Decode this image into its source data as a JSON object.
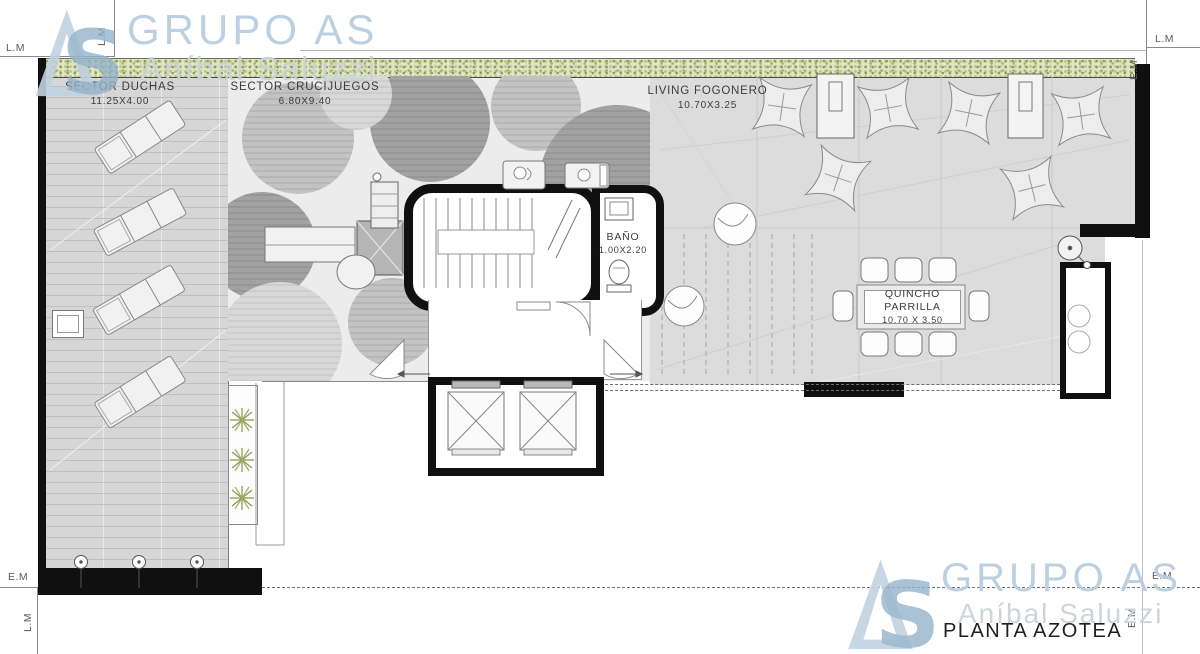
{
  "title": "PLANTA AZOTEA",
  "brand": {
    "company": "GRUPO AS",
    "owner": "Aníbal Saluzzi",
    "monogram_s": "S",
    "accent_light": "#c7d8e4",
    "accent_dark": "#93b2ca",
    "script_color": "#cdd2d6"
  },
  "boundary": {
    "lm": "L.M",
    "em": "E.M"
  },
  "rooms": {
    "duchas": {
      "name": "SECTOR DUCHAS",
      "dims": "11.25X4.00"
    },
    "crucijuegos": {
      "name": "SECTOR CRUCIJUEGOS",
      "dims": "6.80X9.40"
    },
    "living": {
      "name": "LIVING FOGONERO",
      "dims": "10.70X3.25"
    },
    "bano": {
      "name": "BAÑO",
      "dims": "1.00X2.20"
    },
    "quincho": {
      "name": "QUINCHO PARRILLA",
      "dims": "10.70 X 3.50"
    }
  },
  "colors": {
    "wall": "#101010",
    "deck": "#d6d6d6",
    "play_floor": "#ececec",
    "living_floor": "#dcdcdc",
    "planter_green": "#8e9e51",
    "watermark_blue": "#b7cde0"
  }
}
